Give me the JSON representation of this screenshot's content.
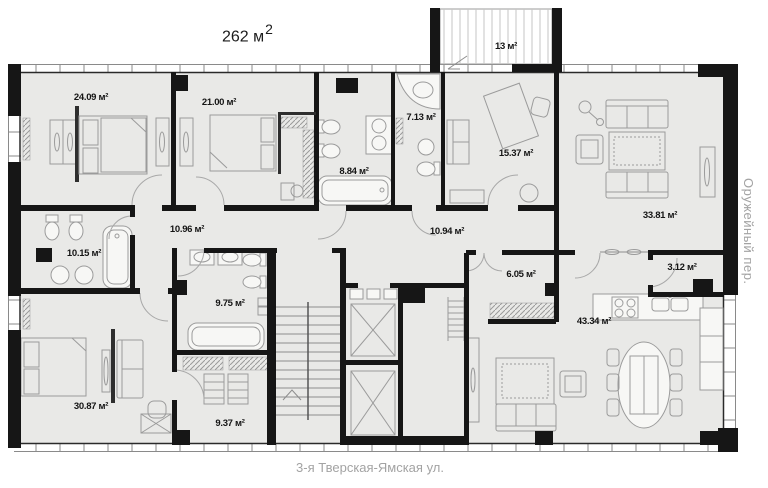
{
  "title": {
    "area": "262 м",
    "sup": "2"
  },
  "streets": {
    "bottom": "3-я Тверская-Ямская ул.",
    "right": "Оружейный пер."
  },
  "rooms": {
    "balcony": "13 м²",
    "bedroom1": "24.09 м²",
    "bedroom2": "21.00 м²",
    "bath1": "8.84 м²",
    "bath2": "7.13 м²",
    "study": "15.37 м²",
    "living": "33.81 м²",
    "corridor1": "10.96 м²",
    "corridor2": "10.94 м²",
    "bath3": "10.15 м²",
    "hall": "6.05 м²",
    "pantry": "3.12 м²",
    "bath4": "9.75 м²",
    "kitchen_living": "43.34 м²",
    "bedroom3": "30.87 м²",
    "wardrobe": "9.37 м²"
  },
  "colors": {
    "floor": "#e9e9e7",
    "wall": "#161616",
    "furniture": "#9b9b9b",
    "street_text": "#a3a3a3",
    "label_text": "#141414"
  }
}
